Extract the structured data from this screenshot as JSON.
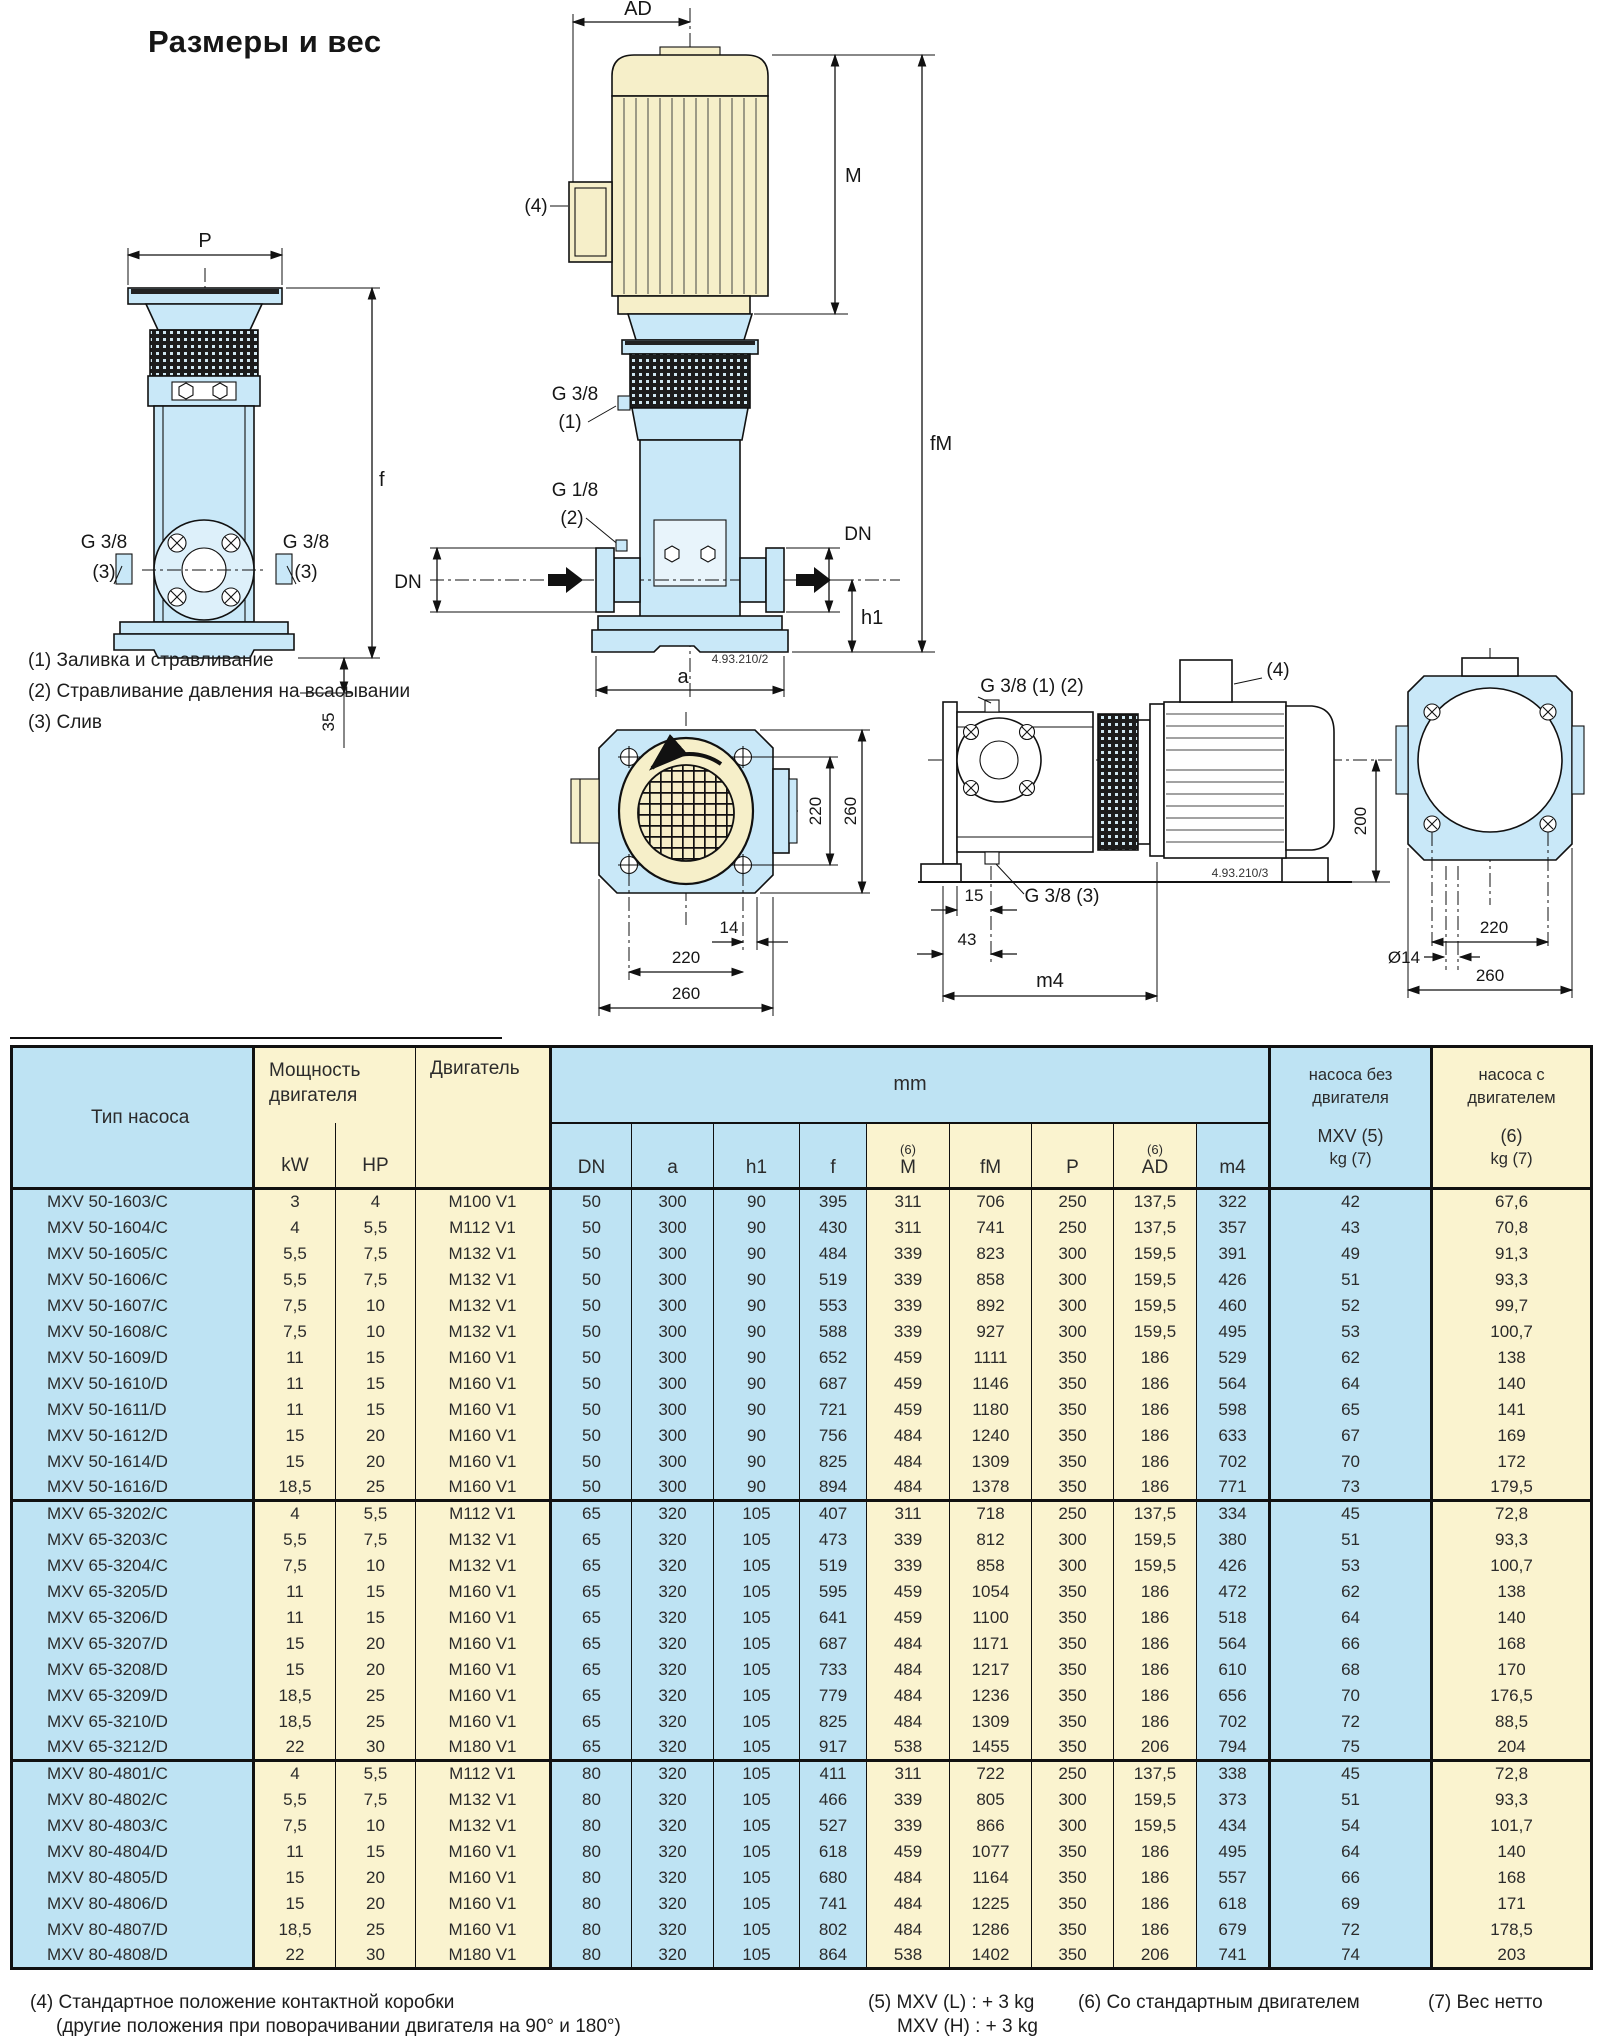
{
  "page": {
    "title": "Размеры и вес"
  },
  "drawing": {
    "labels": {
      "AD": "AD",
      "M": "M",
      "fM": "fM",
      "P": "P",
      "f": "f",
      "h1": "h1",
      "a": "a",
      "DN": "DN",
      "d35": "35",
      "d200": "200",
      "d15": "15",
      "d43": "43",
      "m4": "m4",
      "d14": "14",
      "dia14": "Ø14",
      "d220": "220",
      "d260": "260",
      "g38": "G 3/8",
      "g18": "G 1/8",
      "p1": "(1)",
      "p2": "(2)",
      "p3": "(3)",
      "p4": "(4)",
      "g38_12": "G 3/8 (1) (2)",
      "g38_3": "G 3/8 (3)",
      "code2": "4.93.210/2",
      "code3": "4.93.210/3"
    },
    "notes": [
      "(1) Заливка и стравливание",
      "(2) Стравливание давления на всасывании",
      "(3) Слив"
    ]
  },
  "table": {
    "header": {
      "pump_type": "Тип насоса",
      "power": [
        "Мощность",
        "двигателя"
      ],
      "kw": "kW",
      "hp": "HP",
      "motor": "Двигатель",
      "mm": "mm",
      "sup6": "(6)",
      "dim_cols": [
        "DN",
        "a",
        "h1",
        "f",
        "M",
        "fM",
        "P",
        "AD",
        "m4"
      ],
      "weight_without": [
        "насоса без",
        "двигателя"
      ],
      "weight_without_sub": [
        "MXV (5)",
        "kg (7)"
      ],
      "weight_with": [
        "насоса с",
        "двигателем"
      ],
      "weight_with_sub": [
        "(6)",
        "kg (7)"
      ]
    },
    "sections": [
      {
        "rows": [
          [
            "MXV 50-1603/C",
            "3",
            "4",
            "M100 V1",
            "50",
            "300",
            "90",
            "395",
            "311",
            "706",
            "250",
            "137,5",
            "322",
            "42",
            "67,6"
          ],
          [
            "MXV 50-1604/C",
            "4",
            "5,5",
            "M112 V1",
            "50",
            "300",
            "90",
            "430",
            "311",
            "741",
            "250",
            "137,5",
            "357",
            "43",
            "70,8"
          ],
          [
            "MXV 50-1605/C",
            "5,5",
            "7,5",
            "M132 V1",
            "50",
            "300",
            "90",
            "484",
            "339",
            "823",
            "300",
            "159,5",
            "391",
            "49",
            "91,3"
          ],
          [
            "MXV 50-1606/C",
            "5,5",
            "7,5",
            "M132 V1",
            "50",
            "300",
            "90",
            "519",
            "339",
            "858",
            "300",
            "159,5",
            "426",
            "51",
            "93,3"
          ],
          [
            "MXV 50-1607/C",
            "7,5",
            "10",
            "M132 V1",
            "50",
            "300",
            "90",
            "553",
            "339",
            "892",
            "300",
            "159,5",
            "460",
            "52",
            "99,7"
          ],
          [
            "MXV 50-1608/C",
            "7,5",
            "10",
            "M132 V1",
            "50",
            "300",
            "90",
            "588",
            "339",
            "927",
            "300",
            "159,5",
            "495",
            "53",
            "100,7"
          ],
          [
            "MXV 50-1609/D",
            "11",
            "15",
            "M160 V1",
            "50",
            "300",
            "90",
            "652",
            "459",
            "1111",
            "350",
            "186",
            "529",
            "62",
            "138"
          ],
          [
            "MXV 50-1610/D",
            "11",
            "15",
            "M160 V1",
            "50",
            "300",
            "90",
            "687",
            "459",
            "1146",
            "350",
            "186",
            "564",
            "64",
            "140"
          ],
          [
            "MXV 50-1611/D",
            "11",
            "15",
            "M160 V1",
            "50",
            "300",
            "90",
            "721",
            "459",
            "1180",
            "350",
            "186",
            "598",
            "65",
            "141"
          ],
          [
            "MXV 50-1612/D",
            "15",
            "20",
            "M160 V1",
            "50",
            "300",
            "90",
            "756",
            "484",
            "1240",
            "350",
            "186",
            "633",
            "67",
            "169"
          ],
          [
            "MXV 50-1614/D",
            "15",
            "20",
            "M160 V1",
            "50",
            "300",
            "90",
            "825",
            "484",
            "1309",
            "350",
            "186",
            "702",
            "70",
            "172"
          ],
          [
            "MXV 50-1616/D",
            "18,5",
            "25",
            "M160 V1",
            "50",
            "300",
            "90",
            "894",
            "484",
            "1378",
            "350",
            "186",
            "771",
            "73",
            "179,5"
          ]
        ]
      },
      {
        "rows": [
          [
            "MXV 65-3202/C",
            "4",
            "5,5",
            "M112 V1",
            "65",
            "320",
            "105",
            "407",
            "311",
            "718",
            "250",
            "137,5",
            "334",
            "45",
            "72,8"
          ],
          [
            "MXV 65-3203/C",
            "5,5",
            "7,5",
            "M132 V1",
            "65",
            "320",
            "105",
            "473",
            "339",
            "812",
            "300",
            "159,5",
            "380",
            "51",
            "93,3"
          ],
          [
            "MXV 65-3204/C",
            "7,5",
            "10",
            "M132 V1",
            "65",
            "320",
            "105",
            "519",
            "339",
            "858",
            "300",
            "159,5",
            "426",
            "53",
            "100,7"
          ],
          [
            "MXV 65-3205/D",
            "11",
            "15",
            "M160 V1",
            "65",
            "320",
            "105",
            "595",
            "459",
            "1054",
            "350",
            "186",
            "472",
            "62",
            "138"
          ],
          [
            "MXV 65-3206/D",
            "11",
            "15",
            "M160 V1",
            "65",
            "320",
            "105",
            "641",
            "459",
            "1100",
            "350",
            "186",
            "518",
            "64",
            "140"
          ],
          [
            "MXV 65-3207/D",
            "15",
            "20",
            "M160 V1",
            "65",
            "320",
            "105",
            "687",
            "484",
            "1171",
            "350",
            "186",
            "564",
            "66",
            "168"
          ],
          [
            "MXV 65-3208/D",
            "15",
            "20",
            "M160 V1",
            "65",
            "320",
            "105",
            "733",
            "484",
            "1217",
            "350",
            "186",
            "610",
            "68",
            "170"
          ],
          [
            "MXV 65-3209/D",
            "18,5",
            "25",
            "M160 V1",
            "65",
            "320",
            "105",
            "779",
            "484",
            "1236",
            "350",
            "186",
            "656",
            "70",
            "176,5"
          ],
          [
            "MXV 65-3210/D",
            "18,5",
            "25",
            "M160 V1",
            "65",
            "320",
            "105",
            "825",
            "484",
            "1309",
            "350",
            "186",
            "702",
            "72",
            "88,5"
          ],
          [
            "MXV 65-3212/D",
            "22",
            "30",
            "M180 V1",
            "65",
            "320",
            "105",
            "917",
            "538",
            "1455",
            "350",
            "206",
            "794",
            "75",
            "204"
          ]
        ]
      },
      {
        "rows": [
          [
            "MXV 80-4801/C",
            "4",
            "5,5",
            "M112 V1",
            "80",
            "320",
            "105",
            "411",
            "311",
            "722",
            "250",
            "137,5",
            "338",
            "45",
            "72,8"
          ],
          [
            "MXV 80-4802/C",
            "5,5",
            "7,5",
            "M132 V1",
            "80",
            "320",
            "105",
            "466",
            "339",
            "805",
            "300",
            "159,5",
            "373",
            "51",
            "93,3"
          ],
          [
            "MXV 80-4803/C",
            "7,5",
            "10",
            "M132 V1",
            "80",
            "320",
            "105",
            "527",
            "339",
            "866",
            "300",
            "159,5",
            "434",
            "54",
            "101,7"
          ],
          [
            "MXV 80-4804/D",
            "11",
            "15",
            "M160 V1",
            "80",
            "320",
            "105",
            "618",
            "459",
            "1077",
            "350",
            "186",
            "495",
            "64",
            "140"
          ],
          [
            "MXV 80-4805/D",
            "15",
            "20",
            "M160 V1",
            "80",
            "320",
            "105",
            "680",
            "484",
            "1164",
            "350",
            "186",
            "557",
            "66",
            "168"
          ],
          [
            "MXV 80-4806/D",
            "15",
            "20",
            "M160 V1",
            "80",
            "320",
            "105",
            "741",
            "484",
            "1225",
            "350",
            "186",
            "618",
            "69",
            "171"
          ],
          [
            "MXV 80-4807/D",
            "18,5",
            "25",
            "M160 V1",
            "80",
            "320",
            "105",
            "802",
            "484",
            "1286",
            "350",
            "186",
            "679",
            "72",
            "178,5"
          ],
          [
            "MXV 80-4808/D",
            "22",
            "30",
            "M180 V1",
            "80",
            "320",
            "105",
            "864",
            "538",
            "1402",
            "350",
            "206",
            "741",
            "74",
            "203"
          ]
        ]
      }
    ]
  },
  "footnotes": {
    "f4a": "(4) Стандартное положение контактной коробки",
    "f4b": "(другие положения при поворачивании двигателя на 90° и 180°)",
    "f5a": "(5) MXV (L) : + 3 kg",
    "f5b": "MXV (H) : + 3 kg",
    "f6": "(6) Со стандартным двигателем",
    "f7": "(7) Вес нетто"
  }
}
